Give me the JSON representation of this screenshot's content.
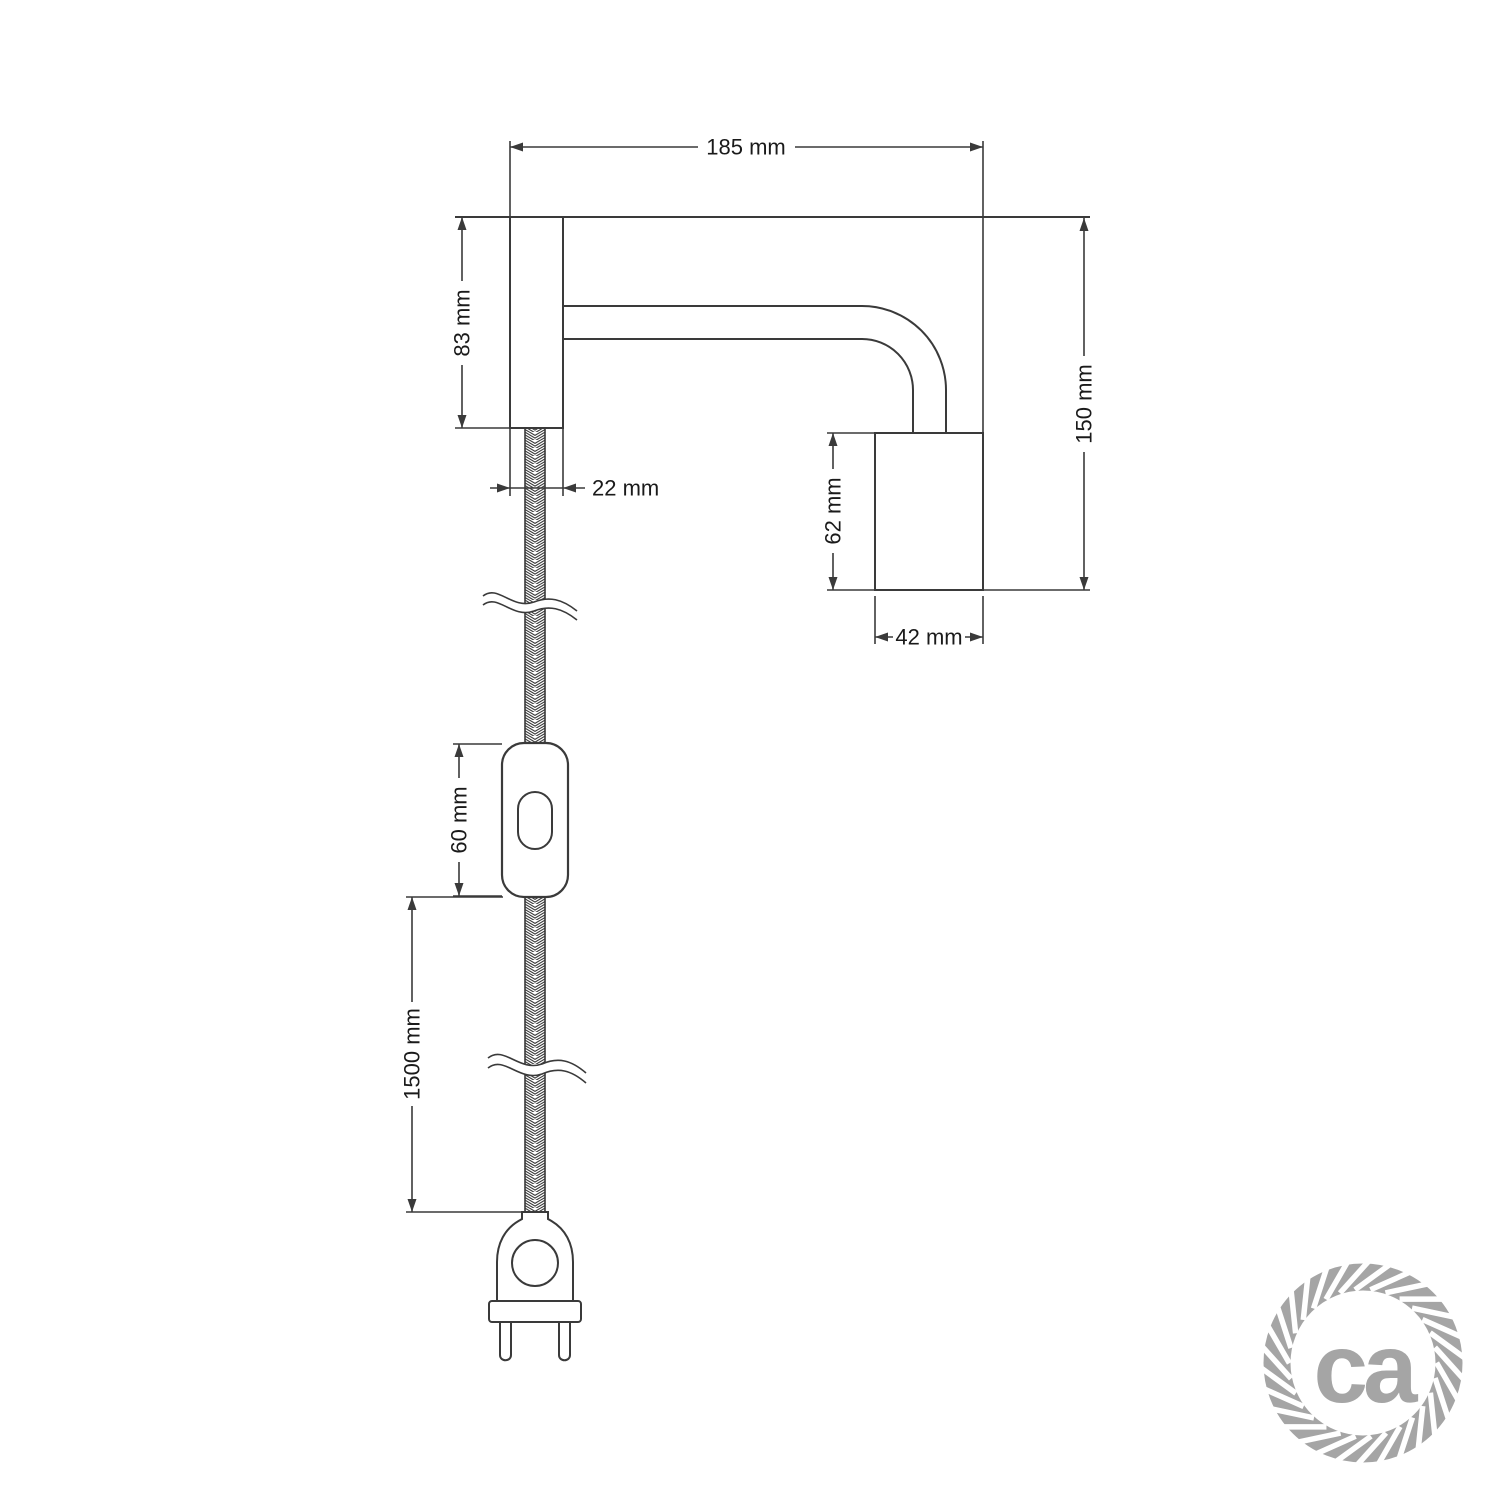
{
  "drawing": {
    "product": "wall-lamp-with-plug-in-cable-technical-drawing",
    "dimensions": {
      "total_width": "185 mm",
      "wall_plate_height": "83 mm",
      "wall_plate_width": "22 mm",
      "total_height": "150 mm",
      "socket_height": "62 mm",
      "socket_width": "42 mm",
      "switch_length": "60 mm",
      "cable_length": "1500 mm"
    }
  },
  "logo": {
    "text": "ca"
  },
  "colors": {
    "line": "#3a3a3a",
    "text": "#1a1a1a",
    "logo_gray": "#a5a5a5",
    "background": "#ffffff"
  }
}
